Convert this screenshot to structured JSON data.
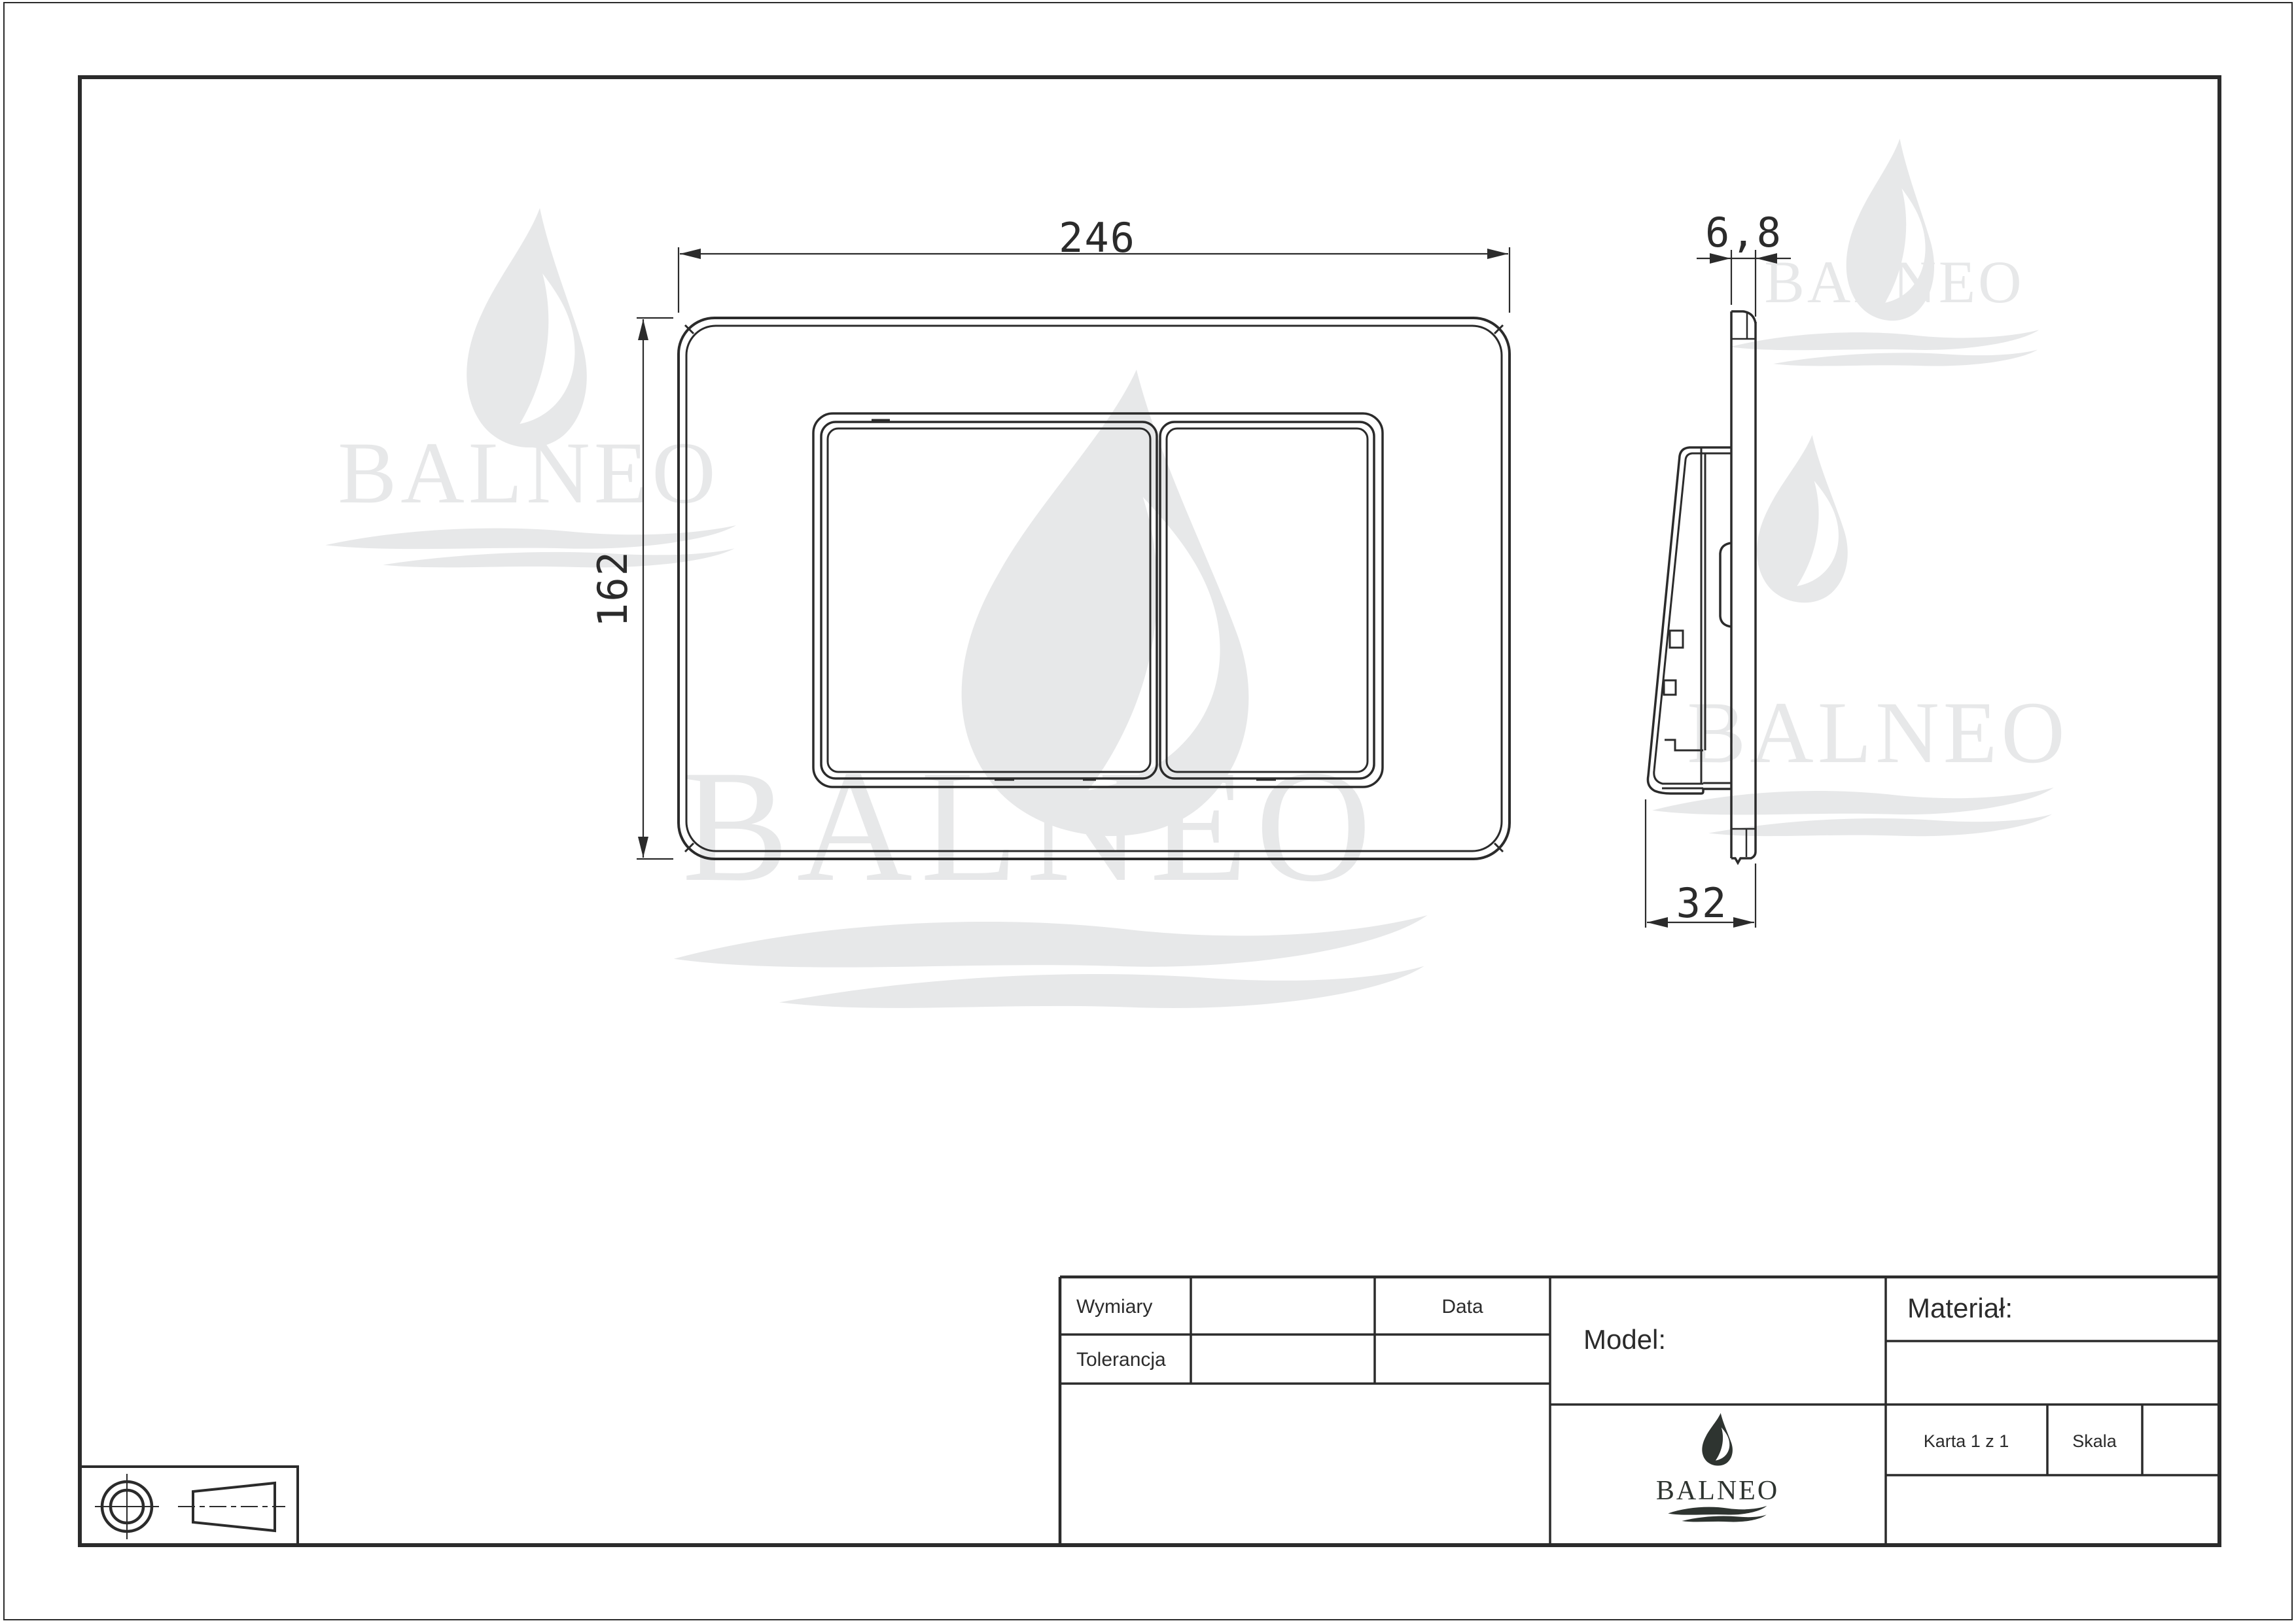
{
  "page": {
    "background": "#ffffff",
    "line_color": "#2b2b2b",
    "watermark_color": "#e7e8e9",
    "logo_color": "#2e3430"
  },
  "views": {
    "front": {
      "width_dim": "246",
      "height_dim": "162"
    },
    "side": {
      "thickness_dim": "6,8",
      "depth_dim": "32"
    }
  },
  "title_block": {
    "wymiary": "Wymiary",
    "tolerancja": "Tolerancja",
    "data": "Data",
    "model": "Model:",
    "material": "Materiał:",
    "karta": "Karta 1 z 1",
    "skala": "Skala"
  },
  "brand": {
    "logo_text": "BALNEO",
    "watermark_text": "BALNEO"
  }
}
